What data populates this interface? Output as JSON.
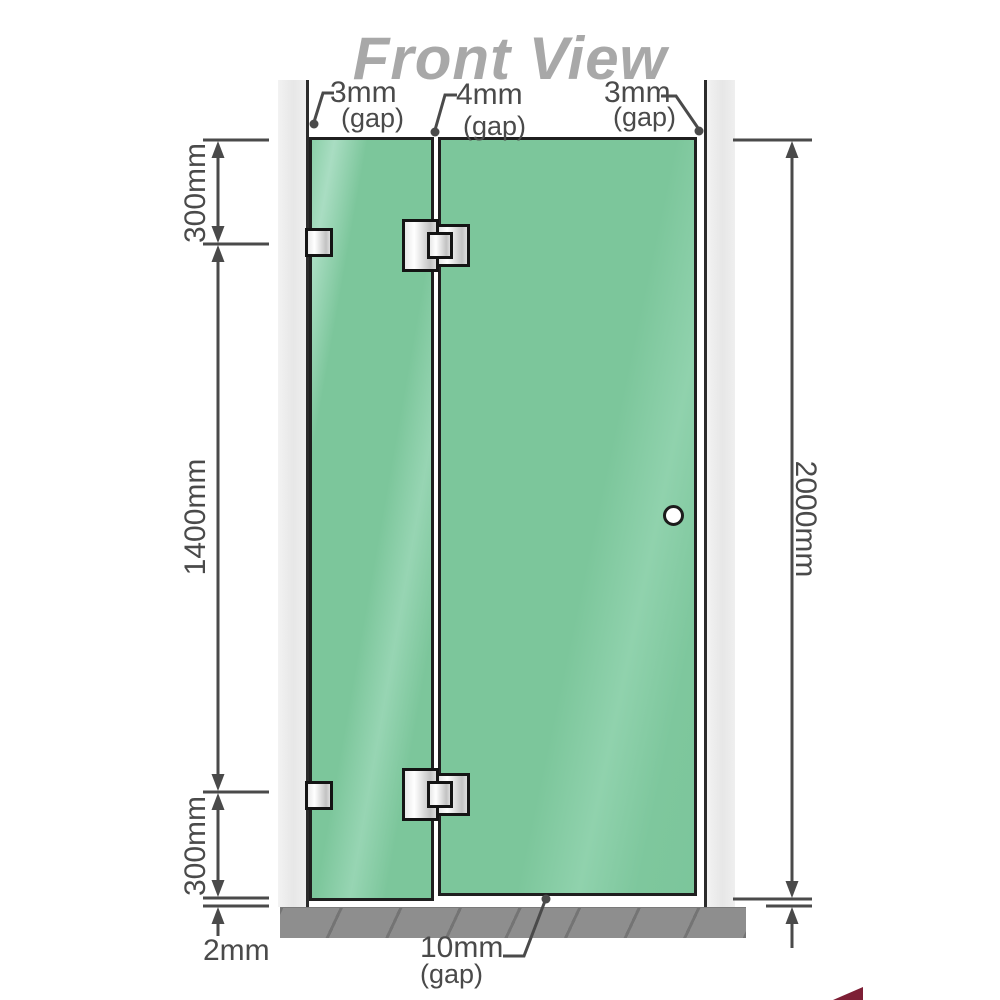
{
  "title": "Front View",
  "annotations": {
    "top_gaps": [
      {
        "value": "3mm",
        "suffix": "(gap)"
      },
      {
        "value": "4mm",
        "suffix": "(gap)"
      },
      {
        "value": "3mm",
        "suffix": "(gap)"
      }
    ],
    "left_dims": [
      "300mm",
      "1400mm",
      "300mm"
    ],
    "bottom_left_dim": "2mm",
    "right_dim": "2000mm",
    "bottom_gap": {
      "value": "10mm",
      "suffix": "(gap)"
    }
  },
  "colors": {
    "glass_green": "#7cc69b",
    "glass_highlight": "#a9ddc2",
    "wall_gray": "#ececec",
    "floor_gray": "#8e8e8e",
    "line_gray": "#4a4a4a",
    "title_gray": "#a8a8a8",
    "hardware_silver": "#e9e9e9",
    "outline_dark": "#1f1f1f",
    "logo_red": "#7d1f35"
  },
  "icons": {
    "handle": "door-handle-circle"
  }
}
